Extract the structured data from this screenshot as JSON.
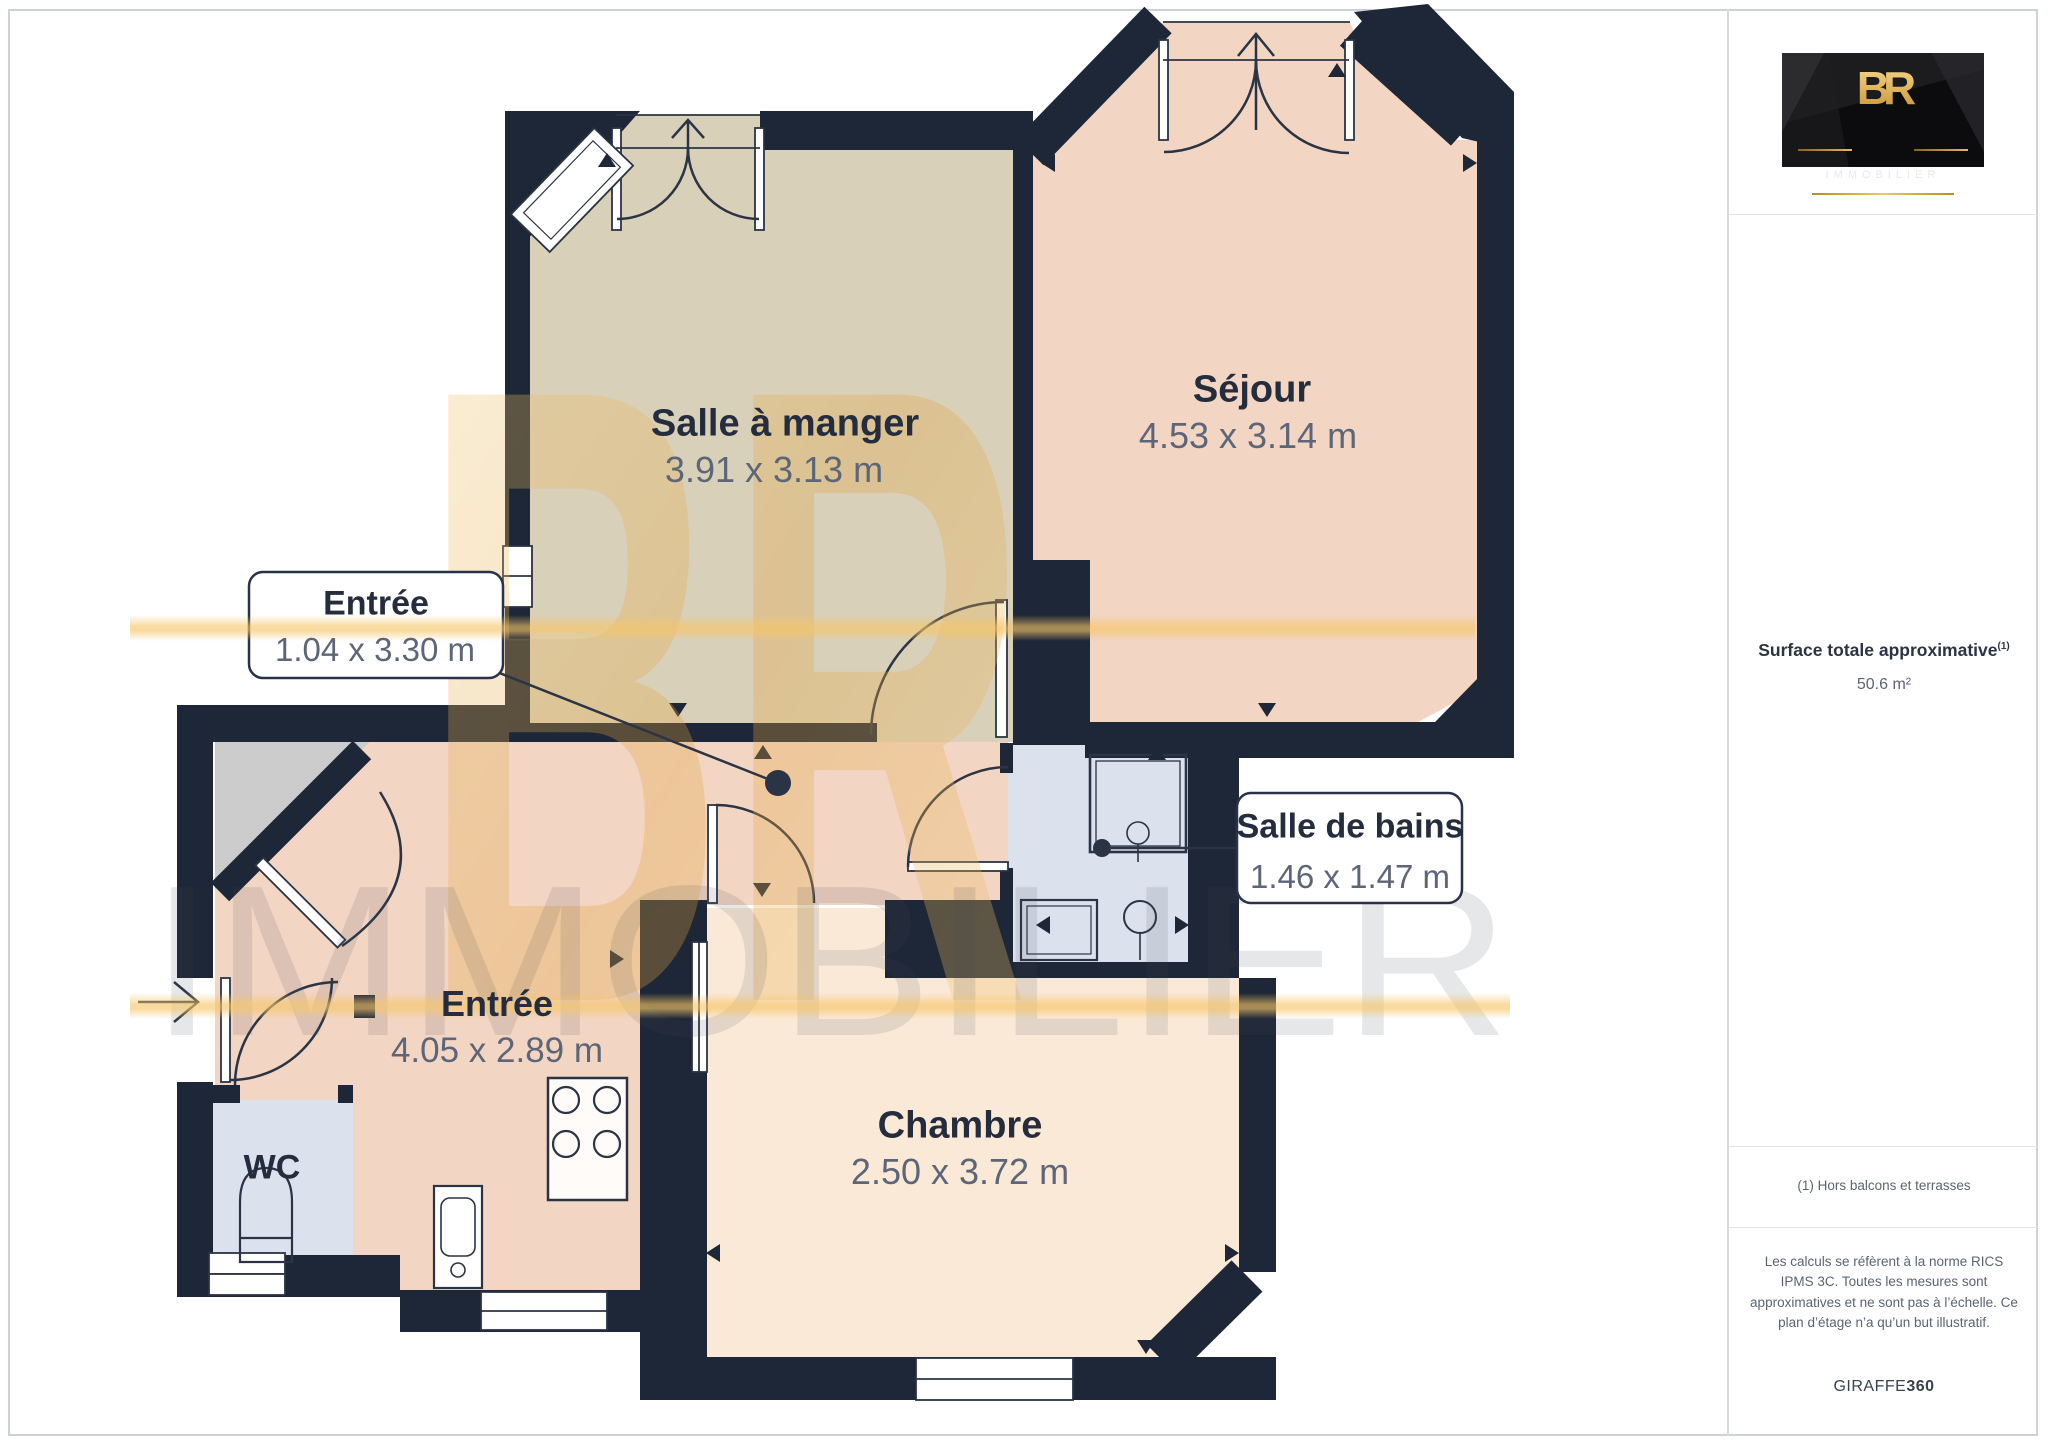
{
  "floorplan": {
    "rooms": [
      {
        "id": "salle-a-manger",
        "name": "Salle à manger",
        "dims": "3.91 x 3.13 m"
      },
      {
        "id": "sejour",
        "name": "Séjour",
        "dims": "4.53 x 3.14 m"
      },
      {
        "id": "entree-couloir",
        "name": "Entrée",
        "dims": "1.04 x 3.30 m"
      },
      {
        "id": "entree",
        "name": "Entrée",
        "dims": "4.05 x 2.89 m"
      },
      {
        "id": "salle-de-bains",
        "name": "Salle de bains",
        "dims": "1.46 x 1.47 m"
      },
      {
        "id": "chambre",
        "name": "Chambre",
        "dims": "2.50 x 3.72 m"
      },
      {
        "id": "wc",
        "name": "WC"
      }
    ],
    "colors": {
      "wall": "#1e2737",
      "dining": "#d9d0b9",
      "living": "#f2d5c3",
      "bedroom": "#fbe9d7",
      "wet-rooms": "#dce1ee",
      "closet": "#cccccc",
      "watermark-gold": "#e8b254"
    },
    "watermark": {
      "monogram": "BR",
      "brand": "IMMOBILIER"
    }
  },
  "sidebar": {
    "logo": {
      "monogram": "BR",
      "name": "IMMOBILIER"
    },
    "surface": {
      "label": "Surface totale approximative",
      "superscript": "(1)",
      "value": "50.6 m²"
    },
    "footnote": "(1) Hors balcons et terrasses",
    "legal": "Les calculs se réfèrent à la norme RICS IPMS 3C. Toutes les mesures sont approximatives et ne sont pas à l’échelle. Ce plan d’étage n’a qu’un but illustratif.",
    "brand": {
      "name": "GIRAFFE",
      "suffix": "360"
    }
  }
}
